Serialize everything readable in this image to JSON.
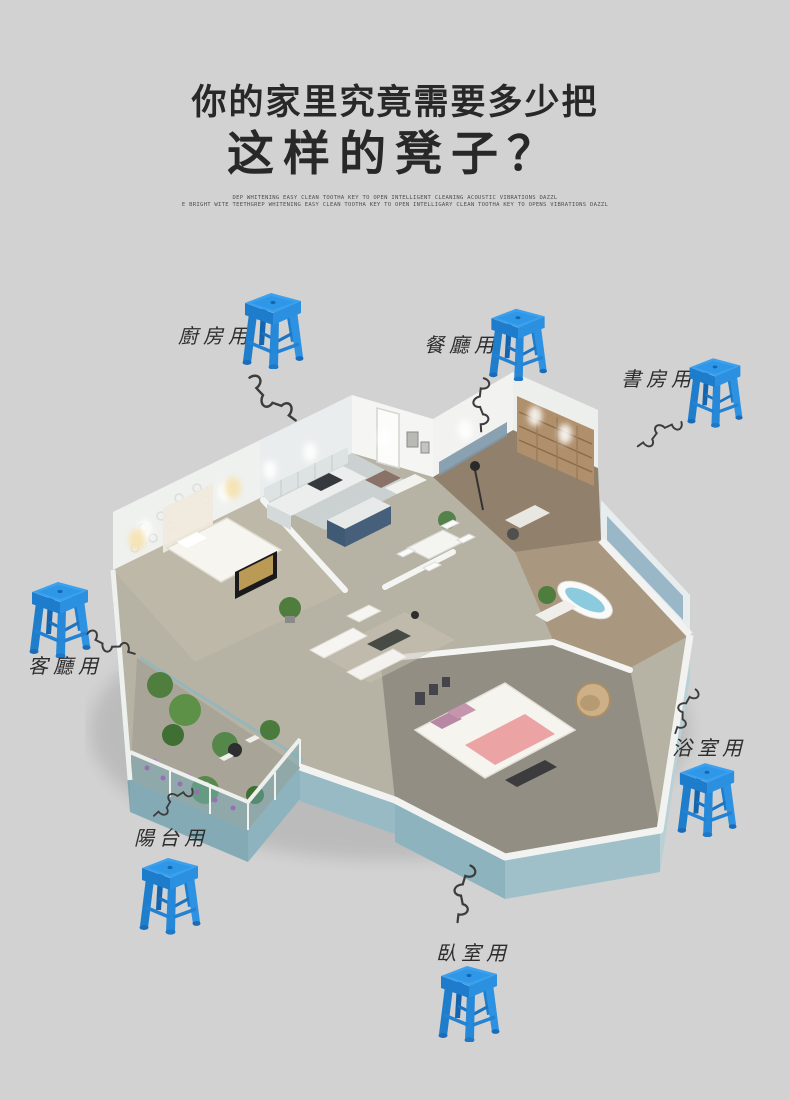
{
  "poster": {
    "background_color": "#d2d2d2",
    "title_line1": "你的家里究竟需要多少把",
    "title_line2": "这样的凳子？",
    "subtext_line1": "DEP WHITENING EASY CLEAN TOOTHA KEY TO OPEN INTELLIGENT CLEANING ACOUSTIC VIBRATIONS DAZZL",
    "subtext_line2": "E BRIGHT WITE TEETHGREP WHITENING EASY CLEAN TOOTHA KEY TO OPEN INTELLIGARY CLEAN TOOTHA KEY TO OPENS VIBRATIONS DAZZL",
    "stool_color": "#2e92e2"
  },
  "callouts": [
    {
      "id": "kitchen",
      "label": "廚房用"
    },
    {
      "id": "dining",
      "label": "餐廳用"
    },
    {
      "id": "study",
      "label": "書房用"
    },
    {
      "id": "living",
      "label": "客廳用"
    },
    {
      "id": "bathroom",
      "label": "浴室用"
    },
    {
      "id": "balcony",
      "label": "陽台用"
    },
    {
      "id": "bedroom",
      "label": "臥室用"
    }
  ]
}
